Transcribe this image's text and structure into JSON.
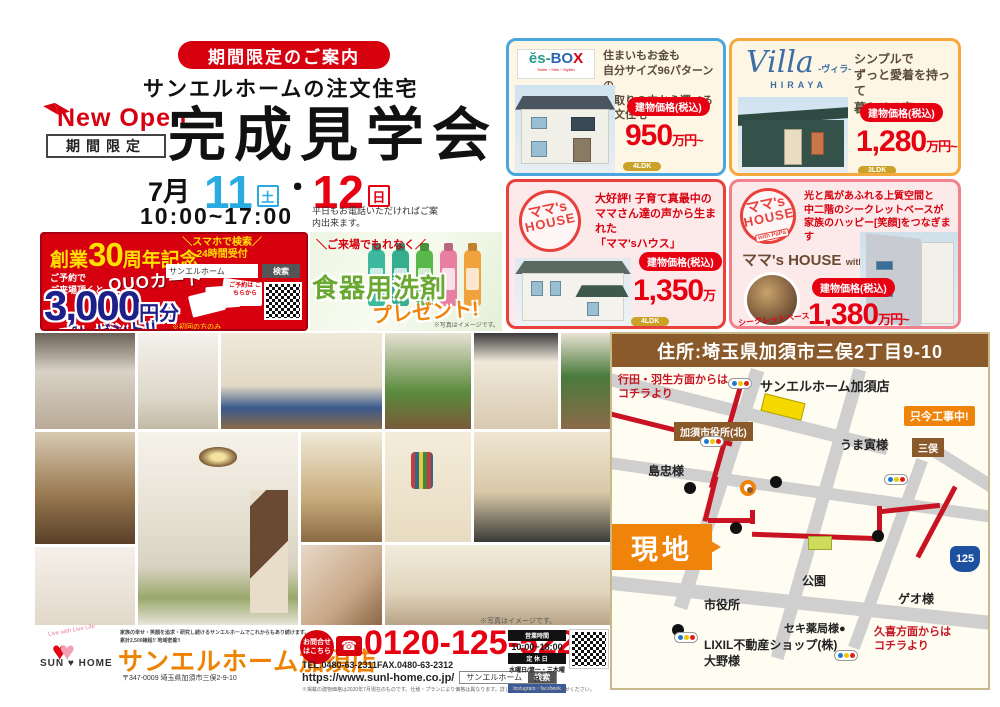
{
  "header": {
    "pill": "期間限定のご案内",
    "subtitle": "サンエルホームの注文住宅",
    "new_open": "New Open",
    "kikan_gentei": "期間限定",
    "title": "完成見学会",
    "month": "7月",
    "day1": "11",
    "day1_wd": "土",
    "sep": "・",
    "day2": "12",
    "day2_wd": "日",
    "time": "10:00~17:00",
    "note": "平日もお電話いただければご案内出来ます。"
  },
  "quo": {
    "anniv_pre": "創業",
    "anniv_num": "30",
    "anniv_post": "周年記念",
    "cond": "ご予約で\nご来場頂くと",
    "quo_word": "QUOカード",
    "amount": "3,000",
    "amount_unit": "円分",
    "present": "プレゼント!!",
    "only_note": "※初回の方のみ",
    "search_note1": "＼スマホで検索／",
    "search_note2": "24時間受付",
    "search_value": "サンエルホーム",
    "search_btn": "検索",
    "reserve": "ご予約は こちらから",
    "card_word": "QUO"
  },
  "detergent": {
    "banner": "＼ご来場でもれなく／",
    "main": "食器用洗剤",
    "sub": "プレゼント!",
    "note": "※写真はイメージです。"
  },
  "cards": [
    {
      "logo": "ĕs-BOX",
      "logo_b": "B",
      "logo_o": "O",
      "logo_x": "X",
      "logo_es": "ĕs-",
      "logo_tagline": "Smile・Slim・Stylish",
      "desc": "住まいもお金も\n自分サイズ96パターンの\n間取りの中から選べる注文住宅",
      "price_label": "建物価格(税込)",
      "price": "950",
      "price_suffix": "万円~",
      "tag1": "4LDK",
      "tag2": "70.45m²"
    },
    {
      "logo": "Villa",
      "logo_kana": "-ヴィラ-",
      "logo_sub": "HIRAYA",
      "desc": "シンプルで\nずっと愛着を持って\n暮らせる家",
      "price_label": "建物価格(税込)",
      "price": "1,280",
      "price_suffix": "万円~",
      "tag1": "3LDK",
      "tag2": "66.66m²"
    },
    {
      "stamp1": "ママ's",
      "stamp2": "HOUSE",
      "desc": "大好評! 子育て真最中の\nママさん達の声から生まれた\n「ママ'sハウス」",
      "price_label": "建物価格(税込)",
      "price": "1,350",
      "price_suffix": "万円~",
      "tag1": "4LDK",
      "tag2": "105.15m²"
    },
    {
      "stamp1": "ママ's",
      "stamp2": "HOUSE",
      "stamp3": "with PaPa",
      "desc": "光と風があふれる上質空間と\n中二階のシークレットベースが\n家族のハッピー[笑顔]をつなぎます",
      "name_main": "ママ's HOUSE",
      "name_with": "with",
      "name_papa": "PaPa",
      "circle_label": "シークレットベース",
      "price_label": "建物価格(税込)",
      "price": "1,380",
      "price_suffix": "万円~"
    }
  ],
  "map": {
    "address": "住所:埼玉県加須市三俣2丁目9-10",
    "from_gyoda": "行田・羽生方面からは\nコチラより",
    "shop": "サンエルホーム加須店",
    "cityhall_north": "加須市役所(北)",
    "construction": "只今工事中!",
    "umatora": "うま寅様",
    "shimachu": "島忠様",
    "genchi": "現地",
    "park": "公園",
    "cityhall": "市役所",
    "seki": "セキ薬局様●",
    "geo": "ゲオ様",
    "mitsumata": "三俣",
    "route_no": "125",
    "from_kuki": "久喜方面からは\nコチラより",
    "lixil": "LIXIL不動産ショップ(株)",
    "ohno": "大野様"
  },
  "footer": {
    "photo_note": "※写真はイメージです。",
    "logo_arc": "Live with Live Life",
    "logo_sun": "SUN",
    "logo_home": "HOME",
    "tagline": "家族の幸せ・笑顔を追求・研究し続けるサンエルホームでこれからもあり続けます。\n累計2,500棟超!! 地域密着!!",
    "store": "サンエルホーム加須店",
    "address": "〒347-0009 埼玉県加須市三俣2-9-10",
    "contact_badge": "お問合せ\nはこちら",
    "phone": "0120-125-522",
    "telfax": "TEL.0480-63-2311FAX.0480-63-2312",
    "url": "https://www.sunl-home.co.jp/",
    "search_value": "サンエルホーム",
    "search_btn": "検索",
    "hours_label": "営業時間",
    "hours": "10:00~18:00",
    "closed_label": "定 休 日",
    "closed": "水曜日/第一・三木曜日",
    "sns": "Instagram・facebook",
    "legal": "※掲載の建物価格は2020年7月現在のものです。仕様・プランにより価格は異なります。詳しくは係員までお問い合わせください。"
  }
}
